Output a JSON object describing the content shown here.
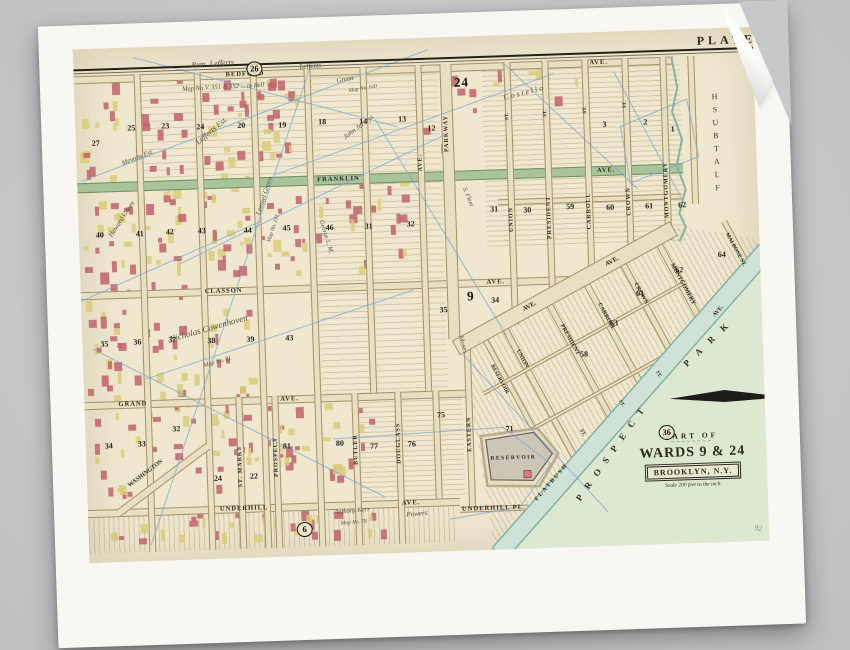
{
  "plate": {
    "heading": "PLATE"
  },
  "cartouche": {
    "part_of": "PART OF",
    "wards": "WARDS 9 & 24",
    "city": "BROOKLYN, N.Y.",
    "scale": "Scale 200 feet to the inch.",
    "ornament": "~~~~~~~~"
  },
  "palette": {
    "paper": "#f8f7f3",
    "plate_bg": "#efe8cf",
    "street": "#e9dfc2",
    "street_edge": "#a4926a",
    "green_ave": "#a9c39b",
    "green_edge": "#70905f",
    "water": "#cfe2d8",
    "water_edge": "#86b2a4",
    "park": "#dde8d2",
    "building_red": "#c0636b",
    "building_yellow": "#d9cb7a",
    "blue_line": "#7da7cf",
    "ink": "#2e2a1f",
    "reservoir": "#ccc6b9"
  },
  "map": {
    "h_streets": [
      {
        "y": 27,
        "h": 8,
        "x1": 0,
        "x2": 600,
        "labels": [
          [
            "BEDFORD",
            152
          ],
          [
            "AVE.",
            516
          ]
        ]
      },
      {
        "y": 134,
        "h": 10,
        "x1": 0,
        "x2": 606,
        "green": true,
        "labels": [
          [
            "FRANKLIN",
            240
          ],
          [
            "AVE.",
            520
          ]
        ]
      },
      {
        "y": 164,
        "h": 6,
        "x1": 420,
        "x2": 604,
        "labels": []
      },
      {
        "y": 243,
        "h": 8,
        "x1": 0,
        "x2": 490,
        "labels": [
          [
            "CLASSON",
            124
          ],
          [
            "AVE.",
            406
          ]
        ]
      },
      {
        "y": 353,
        "h": 8,
        "x1": 0,
        "x2": 381,
        "labels": [
          [
            "GRAND",
            34
          ],
          [
            "AVE.",
            196
          ]
        ]
      },
      {
        "y": 461,
        "h": 8,
        "x1": 0,
        "x2": 372,
        "labels": [
          [
            "UNDERHILL",
            132
          ],
          [
            "AVE.",
            314
          ]
        ]
      },
      {
        "y": 470,
        "h": 6,
        "x1": 372,
        "x2": 440,
        "labels": [
          [
            "UNDERHILL PL.",
            374
          ]
        ]
      }
    ],
    "v_streets": [
      {
        "x": 60,
        "y1": 27,
        "y2": 505
      },
      {
        "x": 120,
        "y1": 27,
        "y2": 505
      },
      {
        "x": 176,
        "y1": 27,
        "y2": 505
      },
      {
        "x": 230,
        "y1": 27,
        "y2": 505
      },
      {
        "x": 286,
        "y1": 27,
        "y2": 353
      },
      {
        "x": 341,
        "y1": 27,
        "y2": 353,
        "label": "AVE.",
        "ly": 116
      },
      {
        "x": 366,
        "w": 12,
        "y1": 27,
        "y2": 302,
        "label": "PARKWAY",
        "ly": 78
      },
      {
        "x": 430,
        "y1": 27,
        "y2": 290,
        "label": "UNION",
        "ly": 172,
        "st_y": 78
      },
      {
        "x": 468,
        "y1": 27,
        "y2": 267,
        "label": "PRESIDENT",
        "ly": 162,
        "st_y": 76
      },
      {
        "x": 508,
        "y1": 27,
        "y2": 248,
        "label": "CARROLL",
        "ly": 160,
        "st_y": 74
      },
      {
        "x": 548,
        "y1": 27,
        "y2": 229,
        "label": "CROWN",
        "ly": 156,
        "st_y": 70
      },
      {
        "x": 586,
        "y1": 27,
        "y2": 211,
        "label": "MONTGOMERY",
        "ly": 132
      },
      {
        "x": 614,
        "y1": 27,
        "y2": 175
      },
      {
        "x": 267,
        "y1": 353,
        "y2": 505,
        "label": "BUTLER",
        "ly": 394
      },
      {
        "x": 310,
        "y1": 353,
        "y2": 505,
        "label": "DOUGLASS",
        "ly": 384
      },
      {
        "x": 348,
        "y1": 353,
        "y2": 461
      },
      {
        "x": 381,
        "y1": 302,
        "y2": 470,
        "label": "EASTERN",
        "ly": 380
      },
      {
        "x": 151,
        "y1": 353,
        "y2": 505,
        "label": "ST. MARKS",
        "ly": 402
      },
      {
        "x": 187,
        "y1": 353,
        "y2": 505,
        "label": "PROSPECT",
        "ly": 394
      }
    ],
    "d_streets": [
      {
        "x": 425,
        "y": 290,
        "len": 150,
        "ang": 63.4,
        "w": 7
      },
      {
        "x": 470,
        "y": 267,
        "len": 134,
        "ang": 63.4,
        "w": 7
      },
      {
        "x": 508,
        "y": 248,
        "len": 117,
        "ang": 63.4,
        "w": 7
      },
      {
        "x": 545,
        "y": 229,
        "len": 102,
        "ang": 63.4,
        "w": 7
      },
      {
        "x": 582,
        "y": 211,
        "len": 86,
        "ang": 63.4,
        "w": 7
      },
      {
        "x": 404,
        "y": 300,
        "len": 112,
        "ang": 63.4,
        "w": 6
      },
      {
        "x": 648,
        "y": 192,
        "len": 45,
        "ang": 63.4,
        "w": 6
      },
      {
        "x": 28,
        "y": 462,
        "len": 112,
        "ang": -35,
        "w": 8
      },
      {
        "x": 398,
        "y": 356,
        "len": 232,
        "ang": -27,
        "w": 4
      },
      {
        "x": 424,
        "y": 404,
        "len": 185,
        "ang": -27,
        "w": 4
      }
    ],
    "labels": [
      {
        "t": "PLATE",
        "x": 624,
        "y": 5,
        "s": 12,
        "ls": 4
      },
      {
        "t": "FLATBUSH",
        "x": 634,
        "y": 62,
        "stack": true,
        "s": 8
      },
      {
        "t": "PROSPECT",
        "x": 486,
        "y": 464,
        "r": -53,
        "s": 9,
        "ls": 9
      },
      {
        "t": "PARK",
        "x": 598,
        "y": 332,
        "r": -42,
        "s": 9,
        "ls": 11
      },
      {
        "t": "FLATBUSH",
        "x": 446,
        "y": 464,
        "r": -47,
        "s": 6,
        "ls": 2
      },
      {
        "t": "AVE.",
        "x": 630,
        "y": 286,
        "r": -47,
        "s": 6
      },
      {
        "t": "AVE.",
        "x": 440,
        "y": 272,
        "r": -27,
        "s": 6.5
      },
      {
        "t": "AVE.",
        "x": 524,
        "y": 230,
        "r": -27,
        "s": 6.5
      },
      {
        "t": "RESERVOIR",
        "x": 404,
        "y": 420,
        "s": 5.5,
        "ls": 1.5
      },
      {
        "t": "WASHINGTON",
        "x": 40,
        "y": 436,
        "r": -35,
        "s": 6
      },
      {
        "t": "UNION",
        "x": 437,
        "y": 314,
        "r": 63,
        "s": 6
      },
      {
        "t": "PRESIDENT",
        "x": 482,
        "y": 290,
        "r": 63,
        "s": 6
      },
      {
        "t": "CARROLL",
        "x": 520,
        "y": 270,
        "r": 63,
        "s": 6
      },
      {
        "t": "CROWN",
        "x": 557,
        "y": 251,
        "r": 63,
        "s": 6
      },
      {
        "t": "MONTGOMERY",
        "x": 594,
        "y": 233,
        "r": 63,
        "s": 6
      },
      {
        "t": "RESERVOIR",
        "x": 411,
        "y": 328,
        "r": 63,
        "s": 5.5
      },
      {
        "t": "MALBONE ST.",
        "x": 650,
        "y": 204,
        "r": 63,
        "s": 5.5
      },
      {
        "t": "ST.",
        "x": 497,
        "y": 396,
        "r": 63,
        "s": 5
      },
      {
        "t": "ST.",
        "x": 537,
        "y": 368,
        "r": 63,
        "s": 5
      },
      {
        "t": "ST.",
        "x": 575,
        "y": 340,
        "r": 63,
        "s": 5
      }
    ],
    "block_numbers": [
      [
        "27",
        16,
        90
      ],
      [
        "25",
        52,
        76
      ],
      [
        "23",
        86,
        75
      ],
      [
        "24",
        121,
        77
      ],
      [
        "20",
        162,
        77
      ],
      [
        "19",
        203,
        78
      ],
      [
        "18",
        243,
        76
      ],
      [
        "14",
        284,
        77
      ],
      [
        "13",
        323,
        76
      ],
      [
        "12",
        352,
        86
      ],
      [
        "3",
        527,
        88
      ],
      [
        "2",
        568,
        87
      ],
      [
        "1",
        595,
        95
      ],
      [
        "31",
        412,
        169
      ],
      [
        "30",
        445,
        171
      ],
      [
        "59",
        488,
        169
      ],
      [
        "60",
        528,
        171
      ],
      [
        "61",
        567,
        171
      ],
      [
        "62",
        600,
        171
      ],
      [
        "40",
        17,
        182
      ],
      [
        "41",
        57,
        182
      ],
      [
        "42",
        87,
        181
      ],
      [
        "43",
        119,
        181
      ],
      [
        "44",
        165,
        182
      ],
      [
        "45",
        204,
        181
      ],
      [
        "46",
        247,
        182
      ],
      [
        "31",
        286,
        182
      ],
      [
        "32",
        328,
        181
      ],
      [
        "34",
        410,
        260
      ],
      [
        "35",
        358,
        268
      ],
      [
        "35",
        18,
        291
      ],
      [
        "36",
        51,
        290
      ],
      [
        "37",
        86,
        289
      ],
      [
        "38",
        125,
        291
      ],
      [
        "39",
        164,
        291
      ],
      [
        "43",
        203,
        291
      ],
      [
        "34",
        19,
        393
      ],
      [
        "33",
        52,
        392
      ],
      [
        "32",
        87,
        378
      ],
      [
        "24",
        127,
        429
      ],
      [
        "22",
        163,
        428
      ],
      [
        "81",
        197,
        399
      ],
      [
        "80",
        250,
        398
      ],
      [
        "77",
        284,
        402
      ],
      [
        "76",
        322,
        401
      ],
      [
        "75",
        352,
        373
      ],
      [
        "71",
        420,
        389
      ],
      [
        "63",
        528,
        287
      ],
      [
        "61",
        555,
        258
      ],
      [
        "62",
        595,
        236
      ],
      [
        "64",
        638,
        222
      ],
      [
        "58",
        497,
        317
      ]
    ],
    "plate_refs": [
      {
        "n": "26",
        "x": 173,
        "y": 18,
        "circ": true
      },
      {
        "n": "36",
        "x": 573,
        "y": 395,
        "circ": true
      },
      {
        "n": "6",
        "x": 208,
        "y": 480,
        "circ": true
      },
      {
        "n": "24",
        "x": 380,
        "y": 38,
        "big": true
      },
      {
        "n": "9",
        "x": 386,
        "y": 252,
        "big": true
      }
    ],
    "handwriting": [
      {
        "t": "Rem. Lefferts",
        "x": 118,
        "y": 15,
        "r": -2,
        "s": 8
      },
      {
        "t": "Lefferts",
        "x": 226,
        "y": 21,
        "r": -2,
        "s": 7
      },
      {
        "t": "Map No.V. 351 & 352 ... to Bell",
        "x": 108,
        "y": 40,
        "r": -1,
        "s": 6.5
      },
      {
        "t": "Green",
        "x": 262,
        "y": 36,
        "r": -8,
        "s": 7
      },
      {
        "t": "Map No. 610",
        "x": 274,
        "y": 48,
        "r": -8,
        "s": 5.5
      },
      {
        "t": "Lefferts Est.",
        "x": 118,
        "y": 94,
        "r": -38,
        "s": 8
      },
      {
        "t": "Mevons Est.",
        "x": 44,
        "y": 112,
        "r": -20,
        "s": 7
      },
      {
        "t": "Howard Green",
        "x": 28,
        "y": 186,
        "r": -55,
        "s": 7
      },
      {
        "t": "John Jerseys",
        "x": 266,
        "y": 94,
        "r": -35,
        "s": 7
      },
      {
        "t": "S. Fleet",
        "x": 390,
        "y": 150,
        "r": 70,
        "s": 6.5
      },
      {
        "t": "George L. M.",
        "x": 246,
        "y": 178,
        "r": 75,
        "s": 6.5
      },
      {
        "t": "Lemuel Green",
        "x": 176,
        "y": 170,
        "r": -70,
        "s": 7
      },
      {
        "t": "Map No. 191",
        "x": 187,
        "y": 198,
        "r": -70,
        "s": 5.5
      },
      {
        "t": "Nicholas Cowenhoven",
        "x": 86,
        "y": 288,
        "r": -14,
        "s": 9
      },
      {
        "t": "Map No. 81",
        "x": 120,
        "y": 318,
        "r": -14,
        "s": 6
      },
      {
        "t": "Moses",
        "x": 382,
        "y": 298,
        "r": 75,
        "s": 7
      },
      {
        "t": "C o s t e l l o",
        "x": 428,
        "y": 58,
        "r": -12,
        "s": 8
      },
      {
        "t": "Anthony Kerr",
        "x": 246,
        "y": 468,
        "r": -3,
        "s": 6.5
      },
      {
        "t": "Map No. 78",
        "x": 252,
        "y": 480,
        "r": -3,
        "s": 5.5
      },
      {
        "t": "Powers",
        "x": 318,
        "y": 472,
        "r": -3,
        "s": 7
      },
      {
        "t": "92",
        "x": 666,
        "y": 496,
        "r": 8,
        "s": 8,
        "c": "#8f8778"
      }
    ]
  },
  "decor": {
    "hatches": [
      {
        "x": 408,
        "y": 33,
        "w": 198,
        "h": 178,
        "a": 0,
        "g": 5
      },
      {
        "x": 238,
        "y": 33,
        "w": 126,
        "h": 208,
        "a": 0,
        "g": 6
      },
      {
        "x": 238,
        "y": 250,
        "w": 126,
        "h": 100,
        "a": 0,
        "g": 6
      },
      {
        "x": 62,
        "y": 33,
        "w": 176,
        "h": 98,
        "a": 0,
        "g": 7
      },
      {
        "x": 270,
        "y": 358,
        "w": 108,
        "h": 100,
        "a": 0,
        "g": 5
      },
      {
        "x": 0,
        "y": 465,
        "w": 370,
        "h": 40,
        "a": 90,
        "g": 5
      },
      {
        "x": 380,
        "y": 196,
        "w": 305,
        "h": 322,
        "a": 63,
        "g": 5,
        "clip": "polygon(0px 112px, 220px 0px, 303px 18px, 25px 316px)"
      }
    ],
    "building_zones": [
      {
        "x": 2,
        "y": 33,
        "w": 56,
        "h": 425,
        "n": 70,
        "seed": 11
      },
      {
        "x": 62,
        "y": 33,
        "w": 56,
        "h": 425,
        "n": 60,
        "seed": 22
      },
      {
        "x": 122,
        "y": 33,
        "w": 52,
        "h": 200,
        "n": 38,
        "seed": 33
      },
      {
        "x": 122,
        "y": 250,
        "w": 52,
        "h": 200,
        "n": 30,
        "seed": 44
      },
      {
        "x": 178,
        "y": 33,
        "w": 50,
        "h": 100,
        "n": 20,
        "seed": 55
      },
      {
        "x": 178,
        "y": 140,
        "w": 50,
        "h": 100,
        "n": 14,
        "seed": 66
      },
      {
        "x": 178,
        "y": 360,
        "w": 50,
        "h": 95,
        "n": 16,
        "seed": 77
      },
      {
        "x": 232,
        "y": 140,
        "w": 105,
        "h": 100,
        "n": 20,
        "seed": 88
      },
      {
        "x": 232,
        "y": 360,
        "w": 60,
        "h": 95,
        "n": 14,
        "seed": 99
      },
      {
        "x": 344,
        "y": 33,
        "w": 60,
        "h": 95,
        "n": 10,
        "seed": 101
      },
      {
        "x": 2,
        "y": 468,
        "w": 300,
        "h": 34,
        "n": 34,
        "seed": 121
      },
      {
        "x": 412,
        "y": 33,
        "w": 120,
        "h": 40,
        "n": 8,
        "seed": 131
      }
    ],
    "blue_lines": [
      [
        5,
        132,
        355,
        12
      ],
      [
        100,
        218,
        368,
        98
      ],
      [
        0,
        252,
        182,
        178
      ],
      [
        238,
        22,
        62,
        498
      ],
      [
        300,
        80,
        424,
        300
      ],
      [
        10,
        300,
        298,
        458
      ],
      [
        62,
        332,
        332,
        252
      ],
      [
        540,
        40,
        604,
        170
      ],
      [
        430,
        28,
        560,
        158
      ],
      [
        60,
        10,
        322,
        88
      ],
      [
        380,
        318,
        520,
        480
      ],
      [
        198,
        132,
        480,
        40
      ]
    ],
    "blue_polys": [
      [
        [
          247,
          398
        ],
        [
          418,
          392
        ],
        [
          464,
          430
        ],
        [
          432,
          472
        ],
        [
          362,
          482
        ]
      ],
      [
        [
          545,
          95
        ],
        [
          612,
          70
        ],
        [
          622,
          128
        ],
        [
          553,
          152
        ],
        [
          545,
          95
        ]
      ]
    ],
    "boundary": [
      [
        598,
        27
      ],
      [
        603,
        58
      ],
      [
        597,
        82
      ],
      [
        606,
        110
      ],
      [
        600,
        136
      ],
      [
        608,
        160
      ],
      [
        601,
        184
      ],
      [
        607,
        198
      ],
      [
        600,
        212
      ]
    ],
    "park": [
      [
        692,
        218
      ],
      [
        416,
        526
      ],
      [
        692,
        526
      ]
    ],
    "flatbush": [
      [
        403,
        512
      ],
      [
        685,
        212
      ],
      [
        698,
        225
      ],
      [
        416,
        524
      ]
    ],
    "band": [
      [
        370,
        304
      ],
      [
        591,
        192
      ],
      [
        598,
        206
      ],
      [
        377,
        318
      ]
    ],
    "reservoir_outer": [
      [
        395,
        400
      ],
      [
        452,
        394
      ],
      [
        472,
        420
      ],
      [
        452,
        452
      ],
      [
        400,
        450
      ]
    ],
    "reservoir_inner": [
      [
        400,
        404
      ],
      [
        448,
        398
      ],
      [
        466,
        420
      ],
      [
        446,
        446
      ],
      [
        404,
        444
      ]
    ],
    "reservoir_sq": [
      437,
      436,
      7,
      7
    ],
    "north_arrow": [
      [
        585,
        369
      ],
      [
        640,
        362
      ],
      [
        702,
        371
      ],
      [
        640,
        374
      ]
    ]
  }
}
